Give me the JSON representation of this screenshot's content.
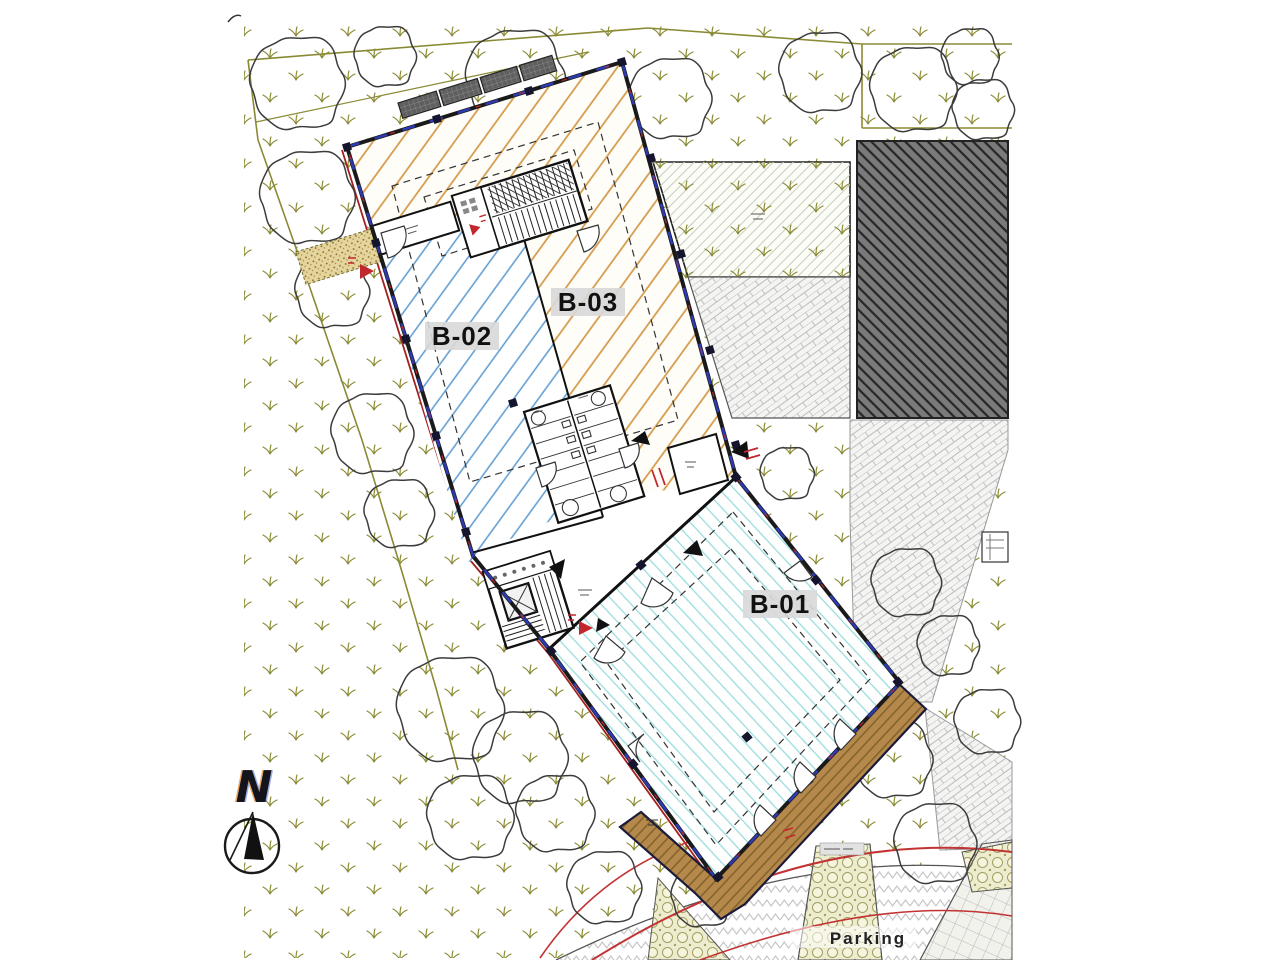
{
  "site_plan": {
    "units": [
      {
        "id": "b01",
        "label": "B-01"
      },
      {
        "id": "b02",
        "label": "B-02"
      },
      {
        "id": "b03",
        "label": "B-03"
      }
    ],
    "parking_label": "Parking",
    "compass": {
      "north_label": "N"
    },
    "colors": {
      "unit_b01_hatch": "#9adcdc",
      "unit_b02_hatch": "#5c9ad0",
      "unit_b03_hatch": "#d49a4a",
      "existing_building_fill": "#7a7a7a",
      "deck_fill": "#b5894b",
      "grass_olive": "#8a8a35",
      "annotation_red": "#c2272e",
      "window_blue": "#2d3ab0",
      "property_line_red": "#a32020"
    }
  }
}
